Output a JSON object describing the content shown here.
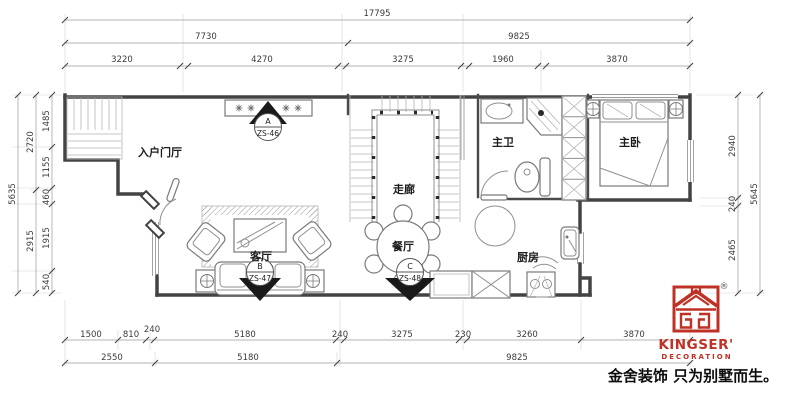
{
  "dims": {
    "top1": "17795",
    "top2": [
      "7730",
      "9825"
    ],
    "top3": [
      "3220",
      "4270",
      "3275",
      "1960",
      "3870"
    ],
    "left_total": "5635",
    "left_mid": [
      "2720",
      "2915"
    ],
    "left_inner": [
      "1485",
      "1155",
      "460",
      "1915",
      "540"
    ],
    "right_inner": [
      "2940",
      "240",
      "2465"
    ],
    "right_total": "5645",
    "bottom1": [
      "1500",
      "810",
      "240",
      "5180",
      "240",
      "3275",
      "230",
      "3260",
      "3870"
    ],
    "bottom2": [
      "2550",
      "5180",
      "9825"
    ]
  },
  "rooms": {
    "entry": "入户门厅",
    "living": "客厅",
    "corridor": "走廊",
    "dining": "餐厅",
    "master_bath": "主卫",
    "master_bed": "主卧",
    "kitchen": "厨房"
  },
  "markers": [
    {
      "letter": "A",
      "code": "ZS-46"
    },
    {
      "letter": "B",
      "code": "ZS-47"
    },
    {
      "letter": "C",
      "code": "ZS-48"
    }
  ],
  "logo": {
    "brand": "KINGSER'",
    "sub": "DECORATION",
    "reg": "®",
    "tagline": "金舍装饰 只为别墅而生。",
    "red": "#bf3124"
  }
}
